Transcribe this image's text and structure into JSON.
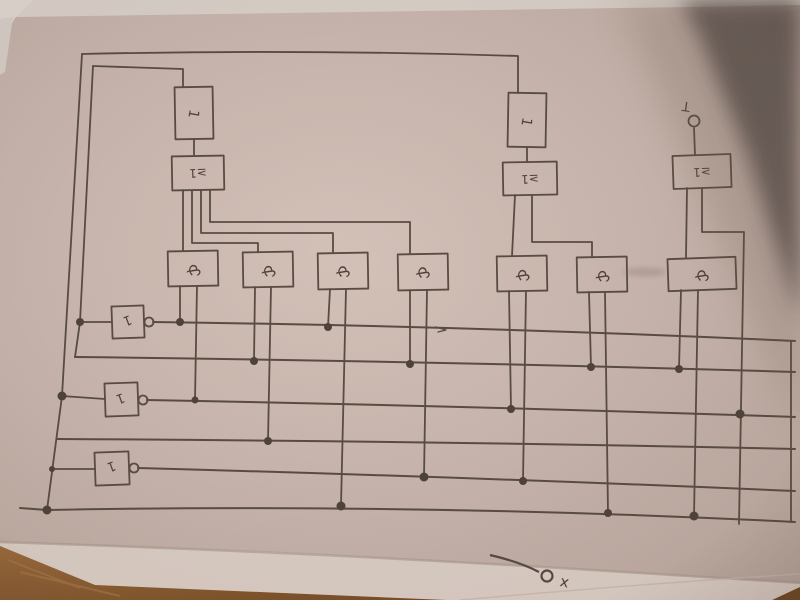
{
  "scene": {
    "description": "Photograph of a hand-drawn IEC logic-gate schematic in pencil on beige paper, lying on a wooden table, with a dark shadow over the top-right corner and a second white sheet visible along the bottom edge",
    "paper_color": "#c9b6ae",
    "under_sheet_color": "#dacdc4",
    "ink_color": "#584c43",
    "wood_color": "#8a5c33",
    "shadow_color": "#3e3631"
  },
  "diagram": {
    "labels": {
      "and": "&",
      "or": "≥1",
      "not": "1",
      "buffer": "1"
    },
    "terminals": {
      "output_label": "T",
      "corner_label": "x"
    },
    "structure": {
      "and_gate_count": 7,
      "or_gate_count": 3,
      "not_gate_count": 3,
      "buffer_box_count": 2,
      "bus_wire_count": 6,
      "summary": "Six horizontal bus wires (three driven by inverter outputs) feed seven 2-input AND gates via dotted junctions; AND outputs rise into three OR (≥1) gates; two OR gates feed tall buffer boxes that loop back along the top edge to the left-side verticals; the right OR gate drives a circled output terminal labelled T; a stray terminal labelled x is drawn on the sheet underneath"
    }
  }
}
